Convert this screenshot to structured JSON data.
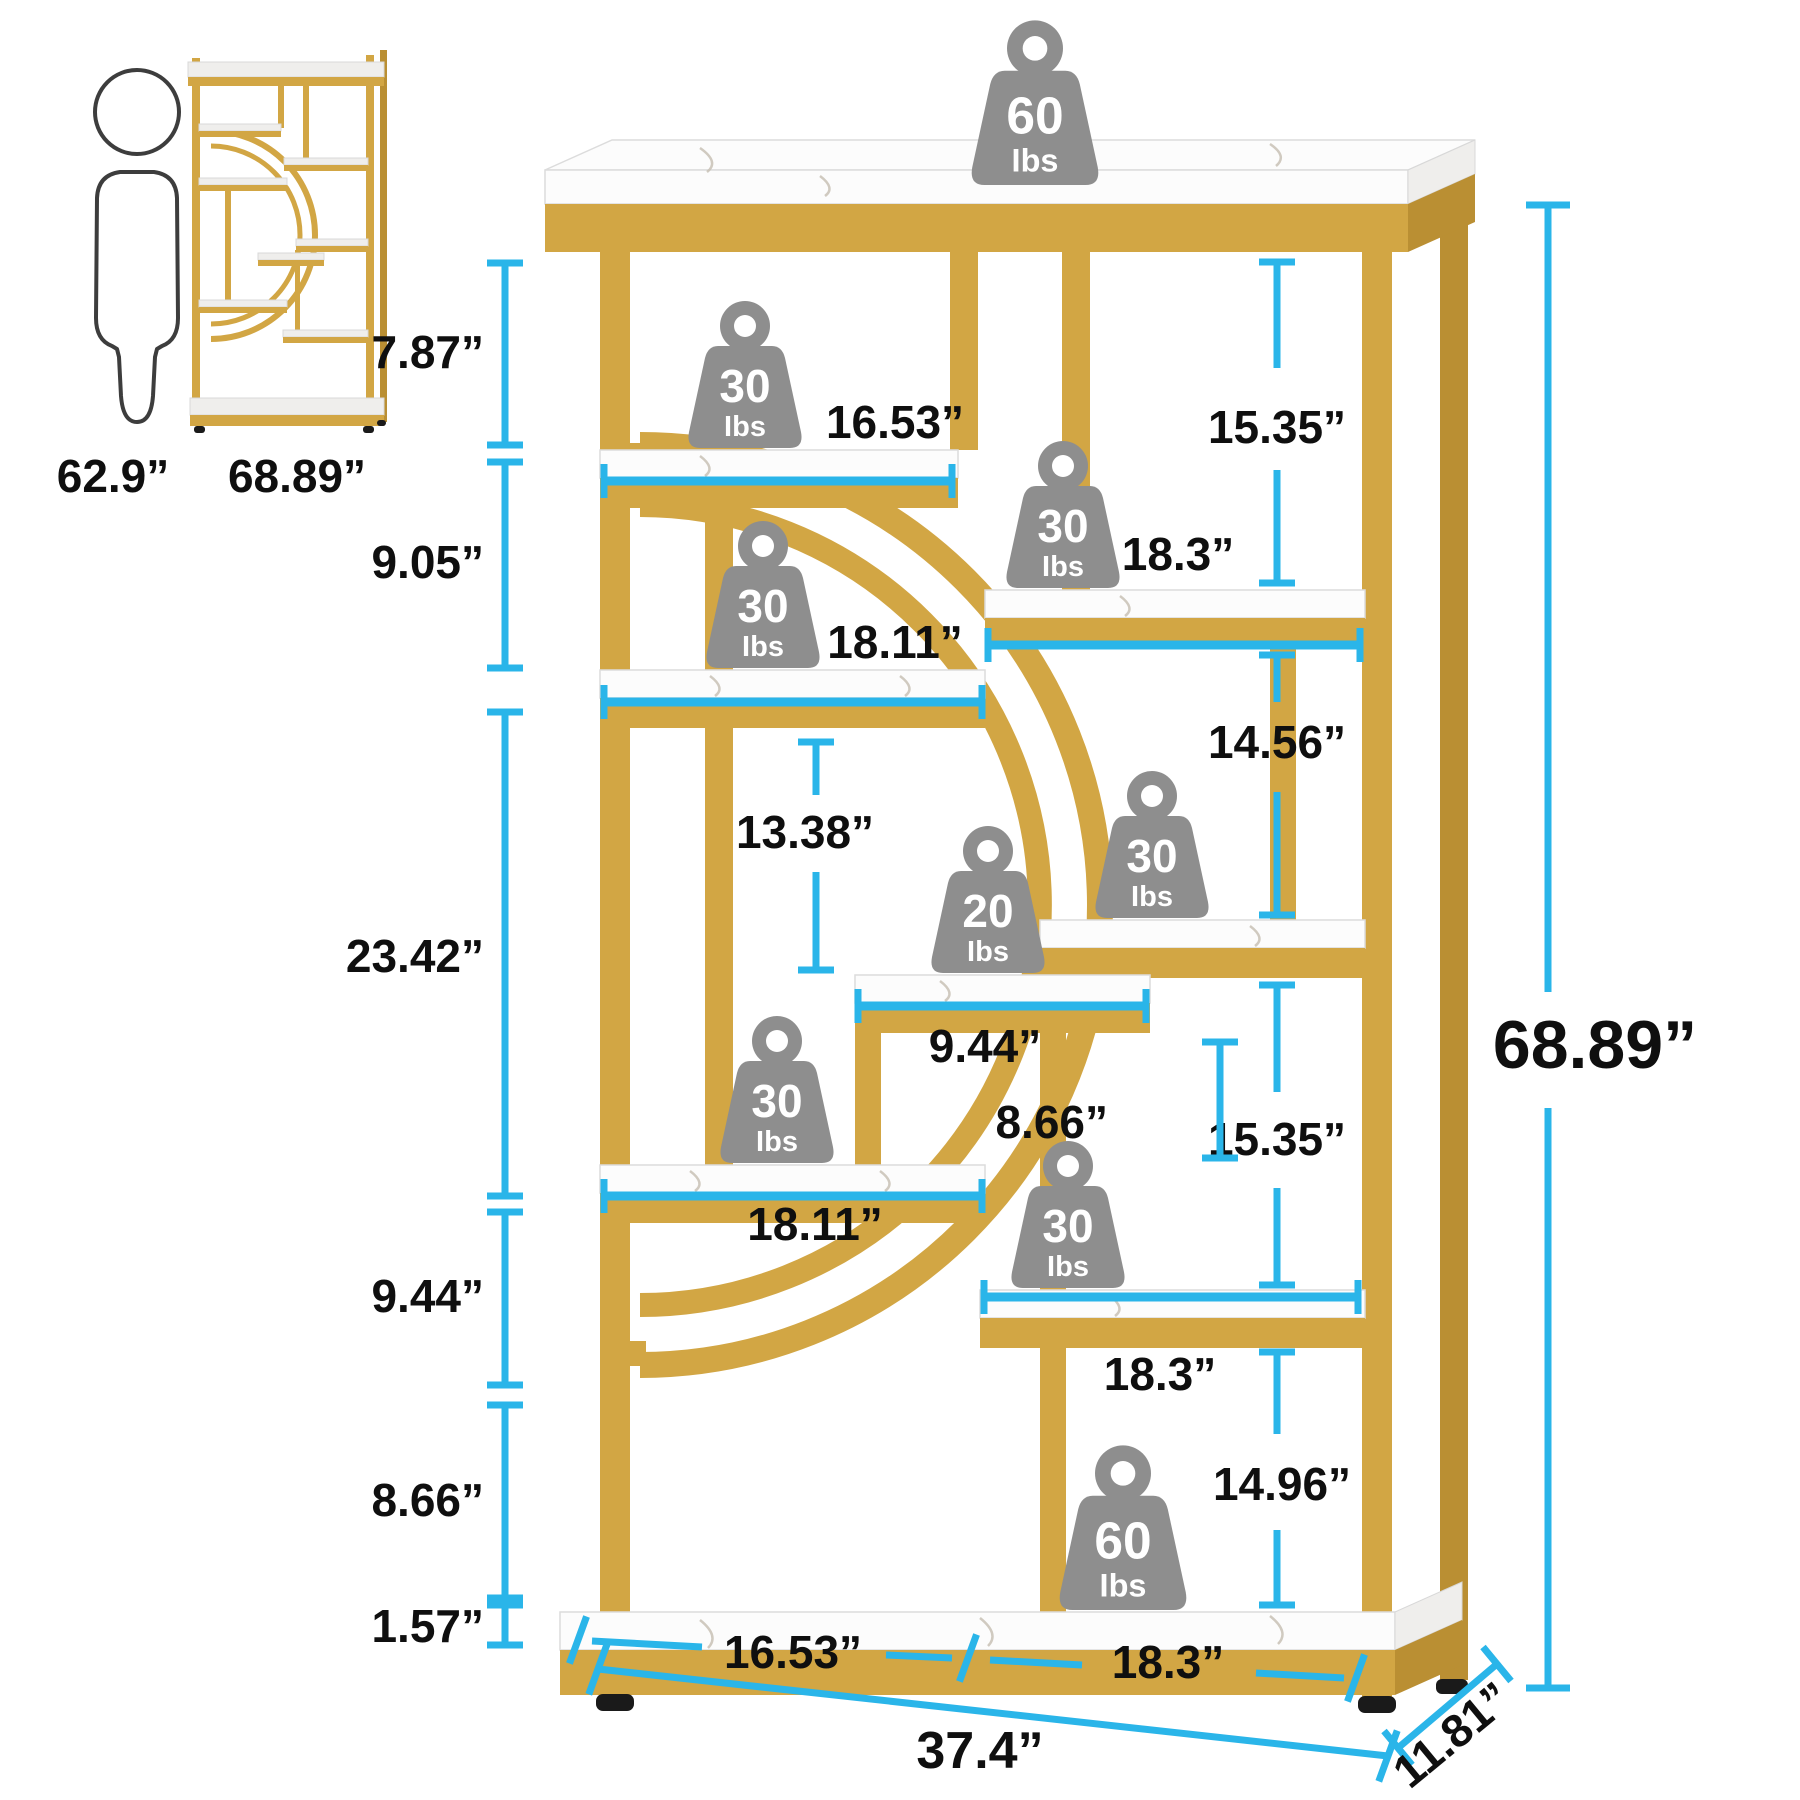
{
  "colors": {
    "accent_cyan": "#2AB5E9",
    "gold": "#D2A644",
    "gold_dark": "#BA8F33",
    "badge_gray": "#8E8E8E",
    "marble": "#FCFCFC",
    "text": "#0F0F0F"
  },
  "scale_figures": {
    "person_height": "62.9”",
    "thumbnail_height": "68.89”"
  },
  "weights": [
    {
      "id": "top-shelf",
      "value": "60",
      "unit": "Ibs"
    },
    {
      "id": "shelf-a",
      "value": "30",
      "unit": "Ibs"
    },
    {
      "id": "shelf-b",
      "value": "30",
      "unit": "Ibs"
    },
    {
      "id": "shelf-c",
      "value": "30",
      "unit": "Ibs"
    },
    {
      "id": "shelf-e",
      "value": "30",
      "unit": "Ibs"
    },
    {
      "id": "shelf-d",
      "value": "20",
      "unit": "Ibs"
    },
    {
      "id": "shelf-f",
      "value": "30",
      "unit": "Ibs"
    },
    {
      "id": "shelf-g",
      "value": "30",
      "unit": "Ibs"
    },
    {
      "id": "bottom-shelf",
      "value": "60",
      "unit": "Ibs"
    }
  ],
  "dims": {
    "left": {
      "top_gap": "7.87”",
      "second_gap": "9.05”",
      "large_gap": "23.42”",
      "lower_gap": "9.44”",
      "lower_gap2": "8.66”",
      "foot": "1.57”"
    },
    "middle": {
      "shelf_a_width": "16.53”",
      "shelf_c_width": "18.11”",
      "opening_height": "13.38”",
      "shelf_d_width": "9.44”",
      "opening_height2": "8.66”",
      "shelf_f_width": "18.11”",
      "bottom_left_width": "16.53”"
    },
    "right": {
      "gap1": "15.35”",
      "shelf_b_width": "18.3”",
      "gap2": "14.56”",
      "gap3": "15.35”",
      "shelf_g_width": "18.3”",
      "gap4": "14.96”",
      "bottom_right_width": "18.3”"
    },
    "overall": {
      "height": "68.89”",
      "width": "37.4”",
      "depth": "11.81”"
    }
  }
}
